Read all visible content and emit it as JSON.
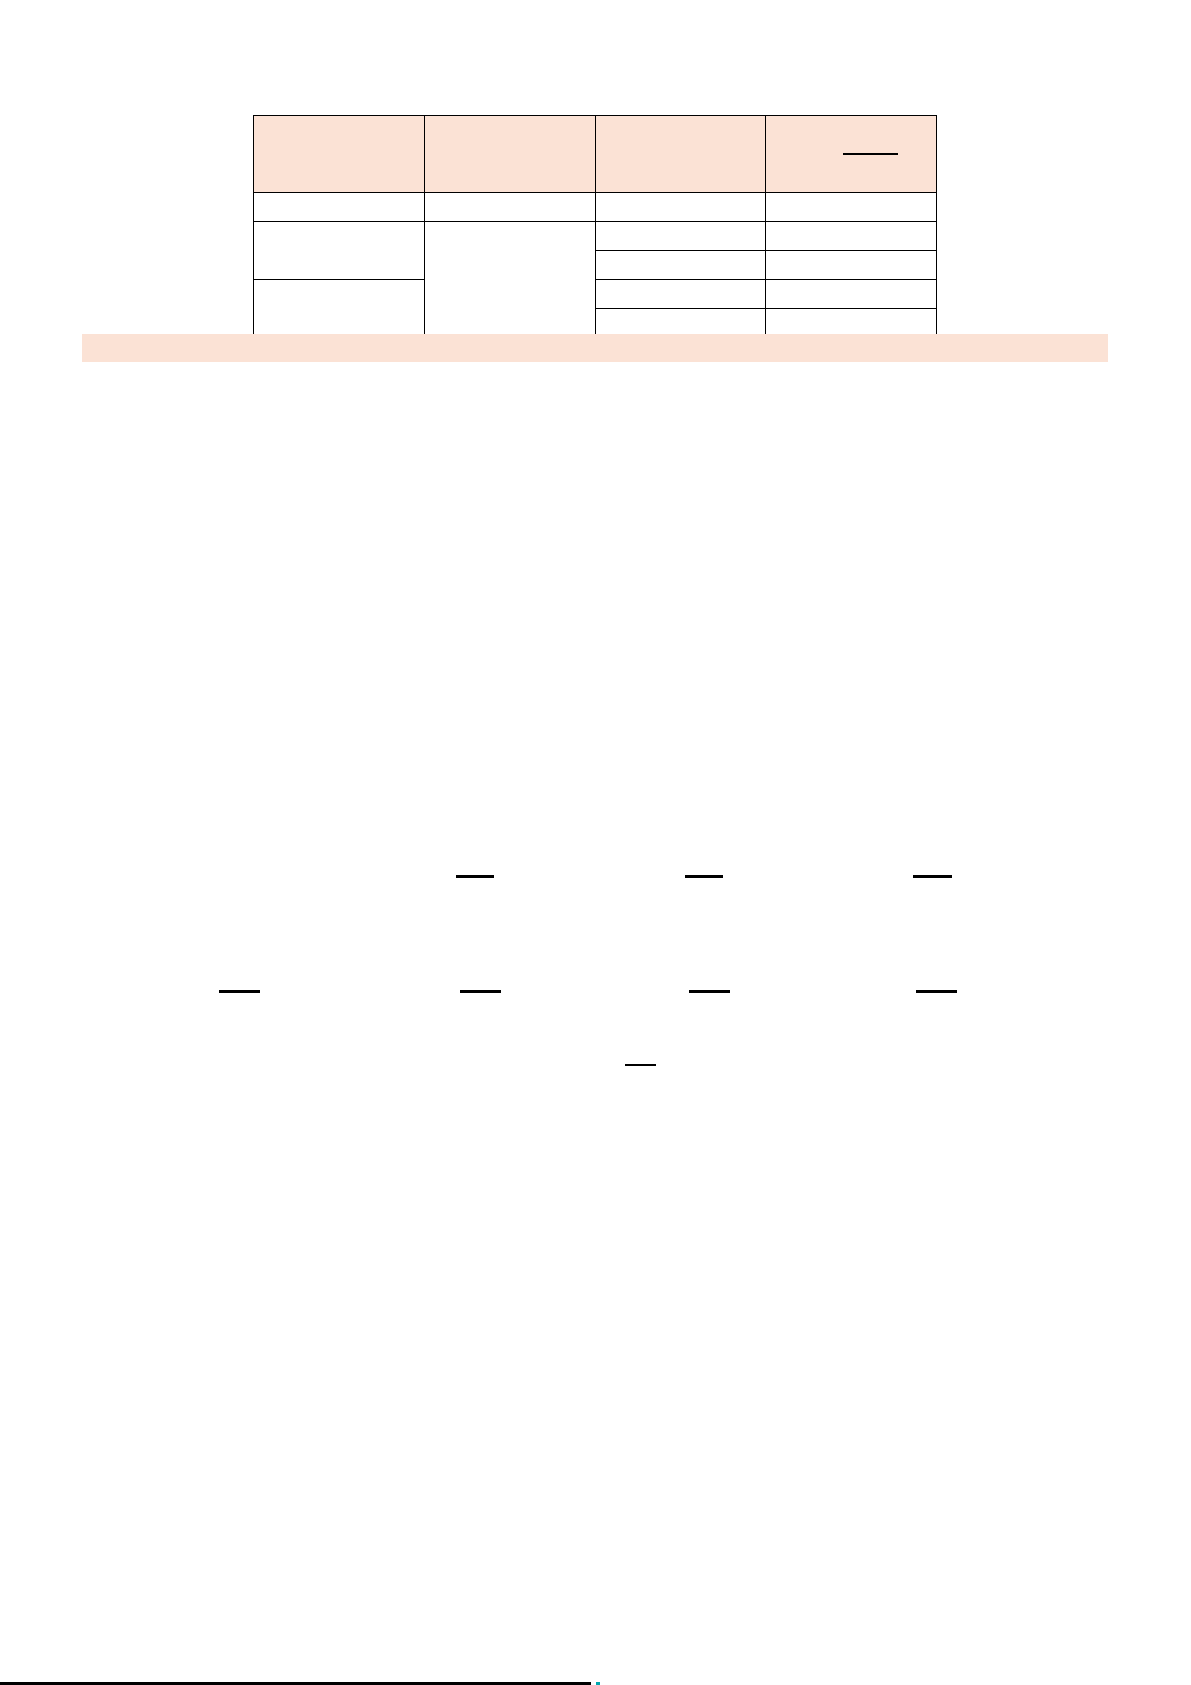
{
  "page": {
    "background_color": "#ffffff",
    "accent_fill_color": "#fbe2d5",
    "border_color": "#000000",
    "cursor_mark_color": "#00a8b0"
  },
  "table": {
    "columns": 4,
    "header_fill": "#fbe2d5",
    "header_cells": [
      "",
      "",
      "",
      ""
    ],
    "header_col4_has_blank_underline": true,
    "row1": [
      "",
      "",
      "",
      ""
    ],
    "body": {
      "col1_cells": [
        "",
        ""
      ],
      "col2_cell": "",
      "col3_cells": [
        "",
        "",
        "",
        ""
      ],
      "col4_cells": [
        "",
        "",
        "",
        ""
      ]
    }
  },
  "highlight_band": {
    "text": "",
    "color": "#fbe2d5"
  },
  "blank_line_rows": {
    "row_a_count": 3,
    "row_a_labels": [
      "",
      "",
      ""
    ],
    "row_b_count": 4,
    "row_b_labels": [
      "",
      "",
      "",
      ""
    ],
    "single_short_line": ""
  },
  "footer": {
    "rule_text": "",
    "has_cursor_mark": true
  }
}
